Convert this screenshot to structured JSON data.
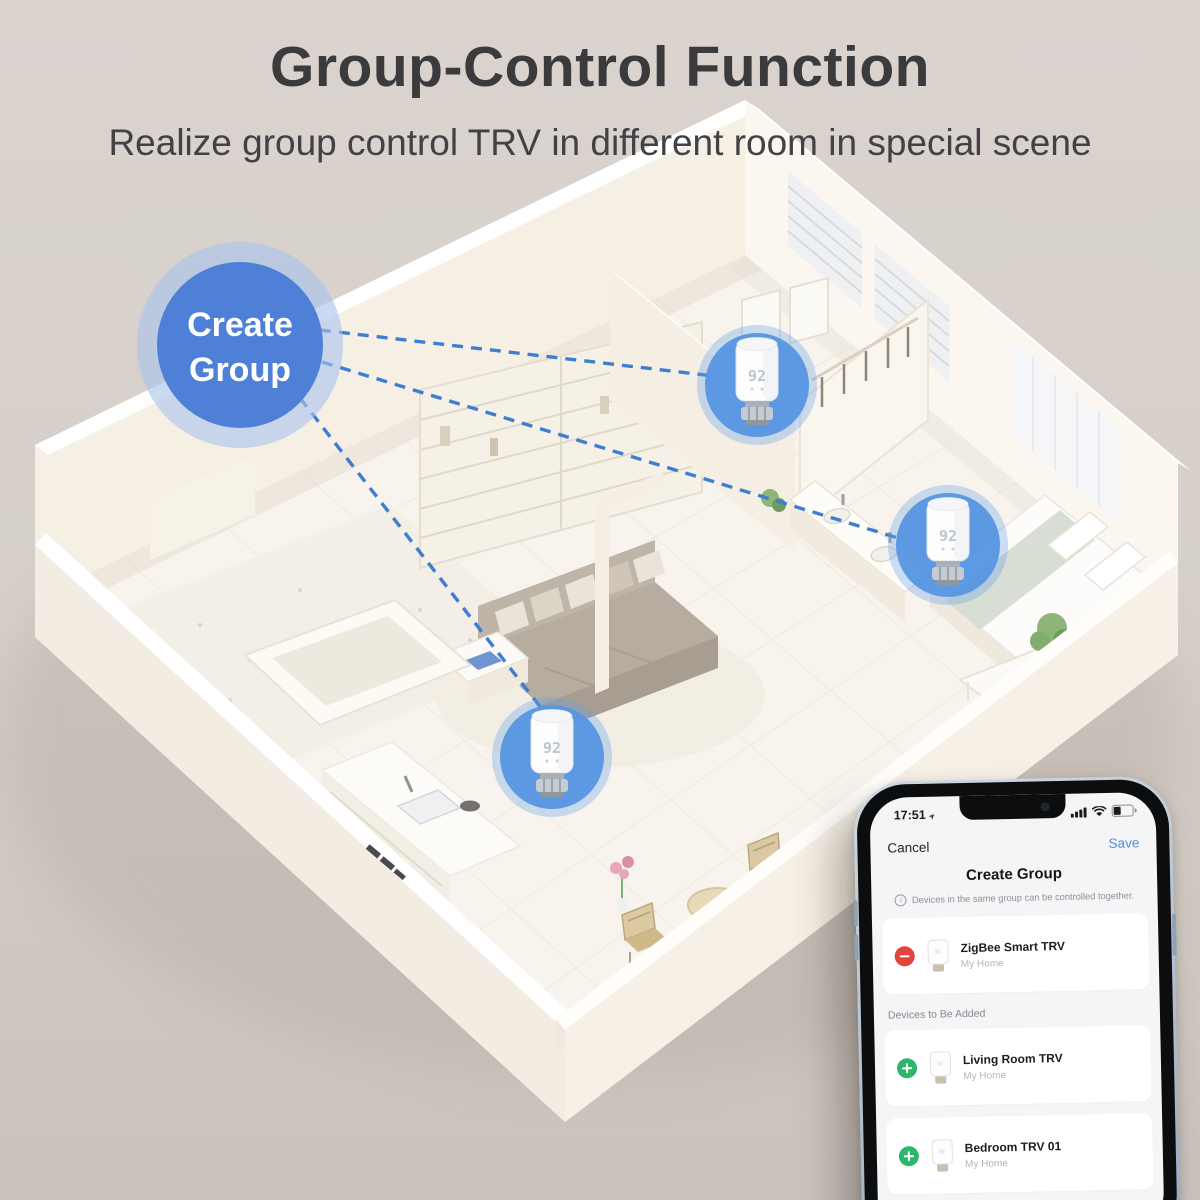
{
  "header": {
    "title": "Group-Control Function",
    "subtitle": "Realize group control TRV in different room in special scene"
  },
  "plan": {
    "badge_label": {
      "line1": "Create",
      "line2": "Group"
    },
    "trv_display": "92"
  },
  "phone": {
    "status": {
      "time": "17:51"
    },
    "nav": {
      "cancel": "Cancel",
      "save": "Save"
    },
    "title": "Create Group",
    "note": "Devices in the same group can be controlled together.",
    "group_devices": [
      {
        "name": "ZigBee Smart TRV",
        "location": "My Home"
      }
    ],
    "section_label": "Devices to Be Added",
    "devices_to_add": [
      {
        "name": "Living Room TRV",
        "location": "My Home"
      },
      {
        "name": "Bedroom TRV 01",
        "location": "My Home"
      }
    ]
  },
  "icons": {
    "location_arrow": "➤",
    "info": "i"
  },
  "colors": {
    "badge_blue": "#4e80d8",
    "highlight_blue": "#5796e2",
    "link_line_blue": "#3e7ed2",
    "save_blue": "#4a90d9",
    "remove_red": "#e2443a",
    "add_green": "#2eb56d"
  }
}
